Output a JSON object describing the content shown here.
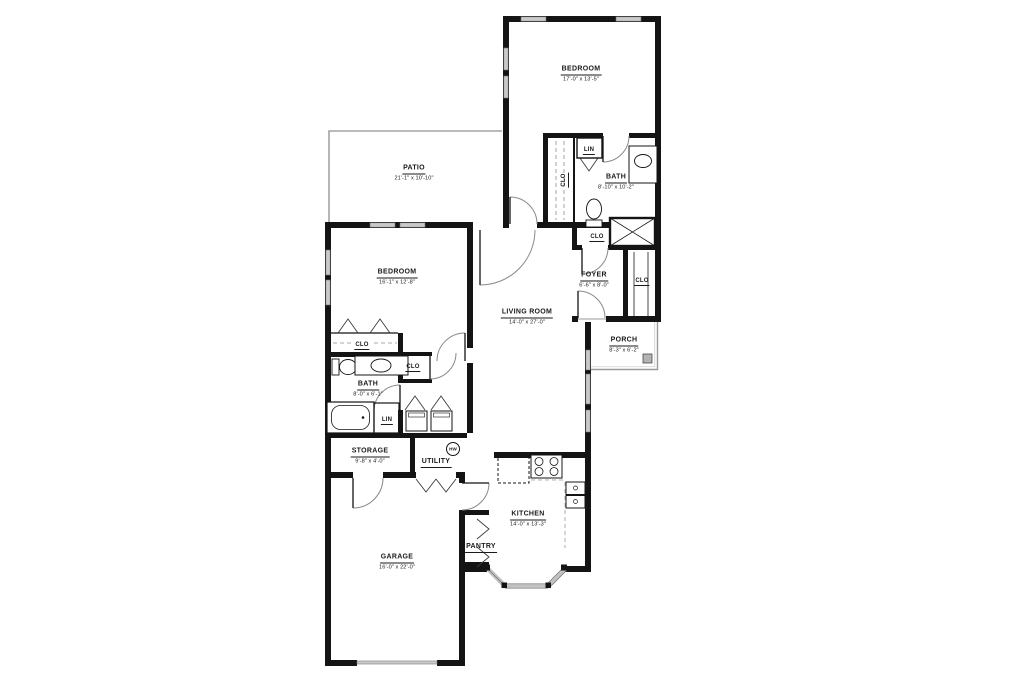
{
  "colors": {
    "wall": "#141414",
    "window_fill": "#c9c9c9",
    "thin_line": "#9a9a9a",
    "text": "#1a1a1a",
    "background": "#ffffff"
  },
  "labels": {
    "bedroom2": {
      "name": "BEDROOM",
      "dims": "17'-0\" x 13'-5\""
    },
    "bath2": {
      "name": "BATH",
      "dims": "8'-10\" x 10'-2\""
    },
    "lin2": {
      "name": "LIN"
    },
    "clo2": {
      "name": "CLO"
    },
    "patio": {
      "name": "PATIO",
      "dims": "21'-1\" x 10'-10\""
    },
    "bedroom1": {
      "name": "BEDROOM",
      "dims": "16'-1\" x 12'-8\""
    },
    "clo_foyer_top": {
      "name": "CLO"
    },
    "foyer": {
      "name": "FOYER",
      "dims": "6'-6\" x 8'-0\""
    },
    "clo_foyer_right": {
      "name": "CLO"
    },
    "living": {
      "name": "LIVING ROOM",
      "dims": "14'-0\" x 27'-0\""
    },
    "porch": {
      "name": "PORCH",
      "dims": "8'-3\" x 6'-2\""
    },
    "clo_bedroom1": {
      "name": "CLO"
    },
    "bath1": {
      "name": "BATH",
      "dims": "8'-0\" x 6'-1\""
    },
    "clo_bath1": {
      "name": "CLO"
    },
    "lin1": {
      "name": "LIN"
    },
    "storage": {
      "name": "STORAGE",
      "dims": "9'-8\" x 4'-0\""
    },
    "utility": {
      "name": "UTILITY"
    },
    "hw": {
      "name": "HW"
    },
    "kitchen": {
      "name": "KITCHEN",
      "dims": "14'-0\" x 13'-3\""
    },
    "pantry": {
      "name": "PANTRY"
    },
    "garage": {
      "name": "GARAGE",
      "dims": "16'-0\" x 22'-0\""
    }
  }
}
